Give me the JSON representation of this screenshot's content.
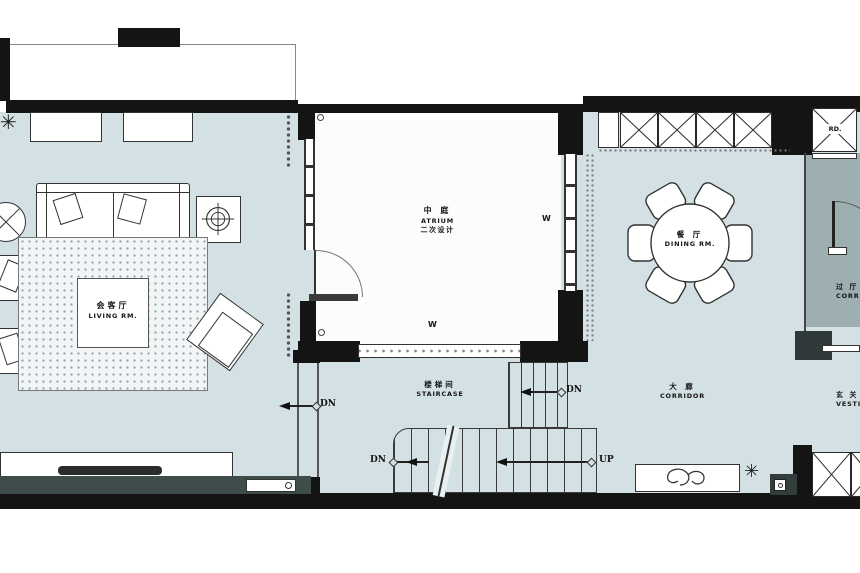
{
  "plan": {
    "rooms": {
      "living": {
        "cn": "会客厅",
        "en": "LIVING RM."
      },
      "atrium": {
        "cn": "中 庭",
        "en": "ATRIUM",
        "note": "二次设计"
      },
      "dining": {
        "cn": "餐 厅",
        "en": "DINING RM."
      },
      "staircase": {
        "cn": "楼梯间",
        "en": "STAIRCASE"
      },
      "corridor": {
        "cn": "大 廊",
        "en": "CORRIDOR"
      },
      "corridor2": {
        "cn": "过 厅",
        "en": "CORRIDOR"
      },
      "vestibule": {
        "cn": "玄 关",
        "en": "VESTIBULE"
      }
    },
    "markers": {
      "dn": "DN",
      "up": "UP",
      "w": "W",
      "rd": "RD."
    },
    "colors": {
      "floor": "#d3e1e5",
      "atrium_floor": "#fbfcfc",
      "dark_room": "#9dafb1",
      "wall": "#141414",
      "feature_wall": "#3e4c4c"
    }
  }
}
